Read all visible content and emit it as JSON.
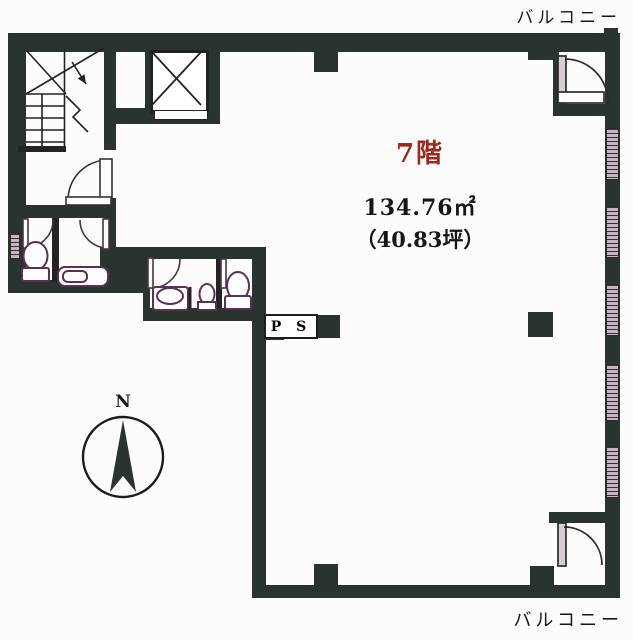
{
  "labels": {
    "balcony_top": "バルコニー",
    "balcony_bottom": "バルコニー",
    "floor": "7階",
    "area_sqm": "134.76㎡",
    "area_tsubo": "（40.83坪）",
    "pipe_shaft": "P S",
    "compass_north": "N"
  },
  "colors": {
    "wall": "#28342d",
    "line": "#1f1f1f",
    "floor_label": "#9e2720",
    "window_fill": "#c9b4c4",
    "fixture_outline": "#5a3154",
    "background": "#fcfcfa"
  }
}
